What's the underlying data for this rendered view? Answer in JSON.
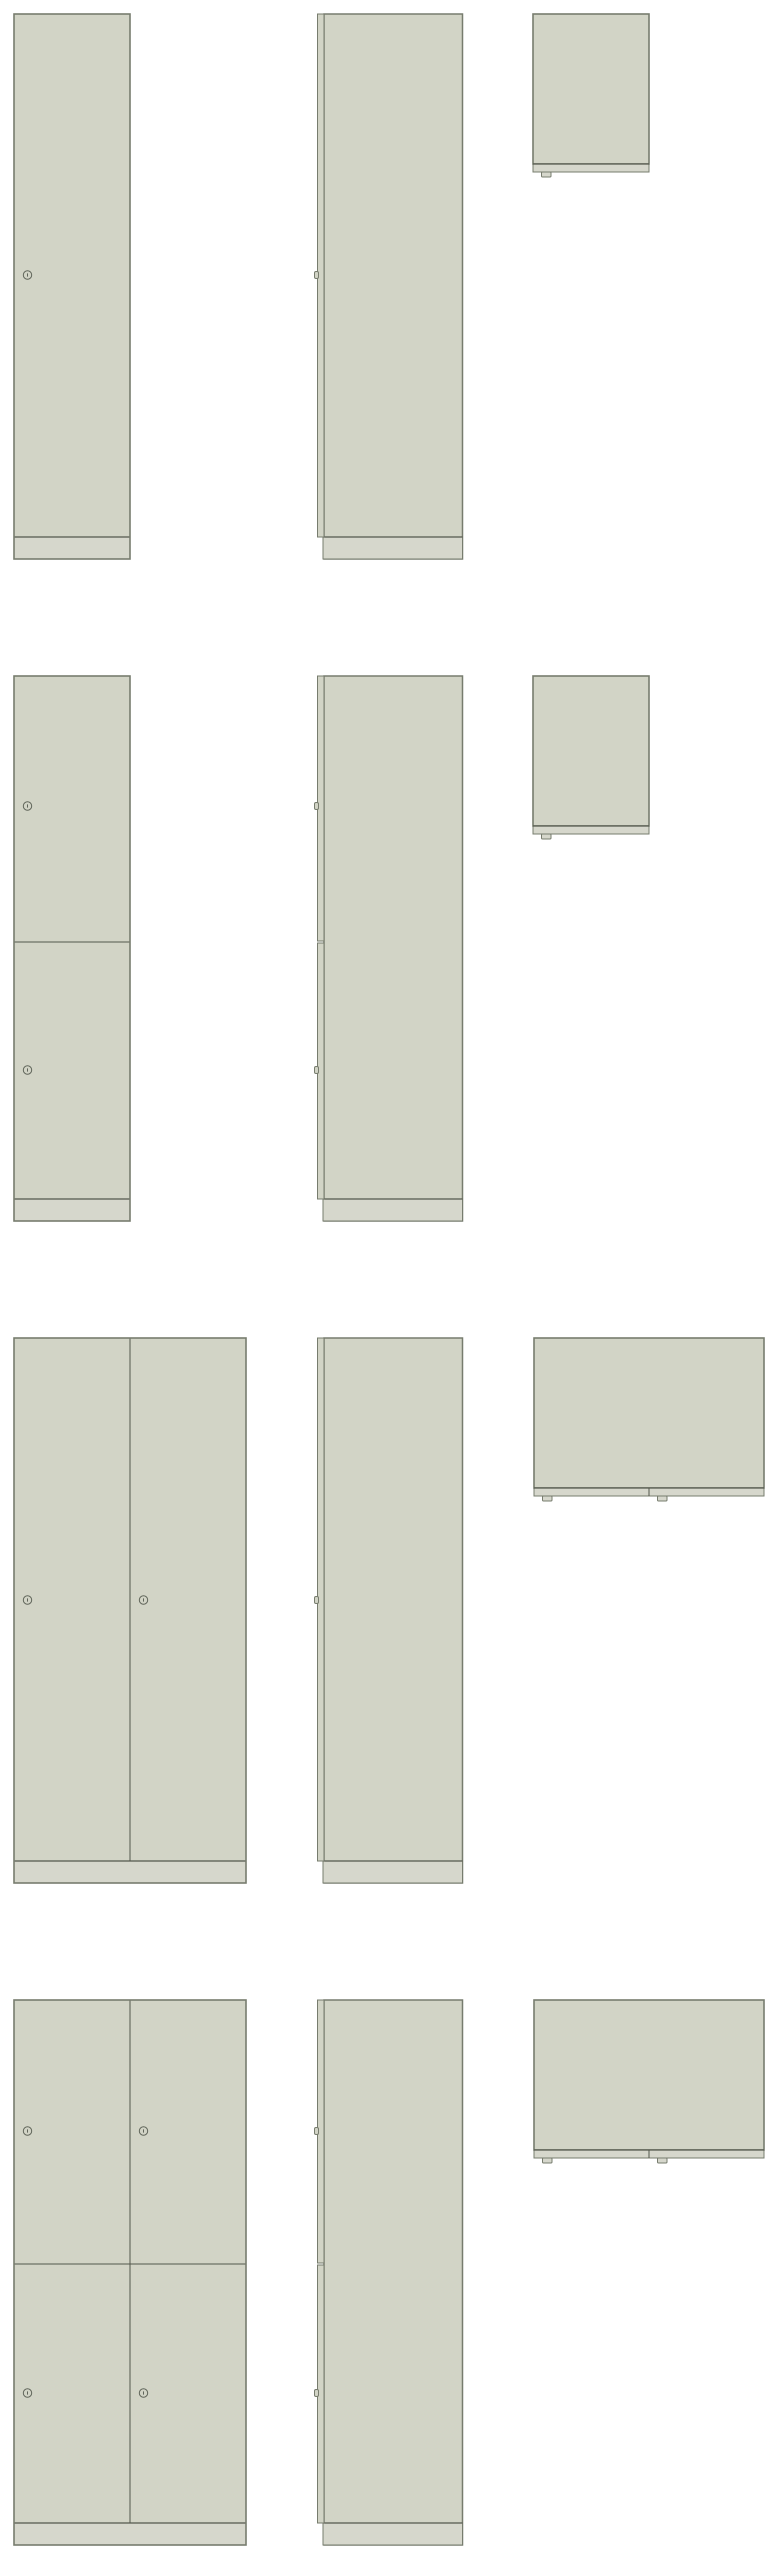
{
  "drawing": {
    "canvas": {
      "width": 777,
      "height": 2560,
      "background": "#ffffff"
    },
    "palette": {
      "body_fill": "#d2d4c6",
      "plinth_fill": "#d6d7cc",
      "outline": "#777c6e",
      "line": "#53574c",
      "lock_stroke": "#60655a"
    },
    "shared": {
      "front": {
        "x": 14,
        "single_width": 116,
        "double_width": 232,
        "door_height": 523,
        "plinth_height": 22,
        "lock_offset_x": 13.5,
        "lock_radius": 4.2
      },
      "side": {
        "strip_x": 317.5,
        "strip_width": 6.5,
        "body_x": 324,
        "body_width": 138.5,
        "plinth_x": 323,
        "bump_width": 4,
        "bump_height": 7
      },
      "top": {
        "x_single": 533,
        "x_double": 534,
        "single_width": 116,
        "double_width": 230,
        "depth": 150,
        "band_height": 8,
        "tab_width": 9.5,
        "tab_height": 5,
        "tab_offset": 8.5
      }
    },
    "rows": [
      {
        "id": "locker-1x1",
        "top": 14,
        "columns": 1,
        "door_rows": 1,
        "divider_y": null,
        "lock_ys": [
          261
        ]
      },
      {
        "id": "locker-1x2",
        "top": 676,
        "columns": 1,
        "door_rows": 2,
        "divider_y": 266,
        "lock_ys": [
          130,
          394
        ]
      },
      {
        "id": "locker-2x1",
        "top": 1338,
        "columns": 2,
        "door_rows": 1,
        "divider_y": null,
        "lock_ys": [
          262
        ]
      },
      {
        "id": "locker-2x2",
        "top": 2000,
        "columns": 2,
        "door_rows": 2,
        "divider_y": 264,
        "lock_ys": [
          131,
          393
        ]
      }
    ]
  }
}
